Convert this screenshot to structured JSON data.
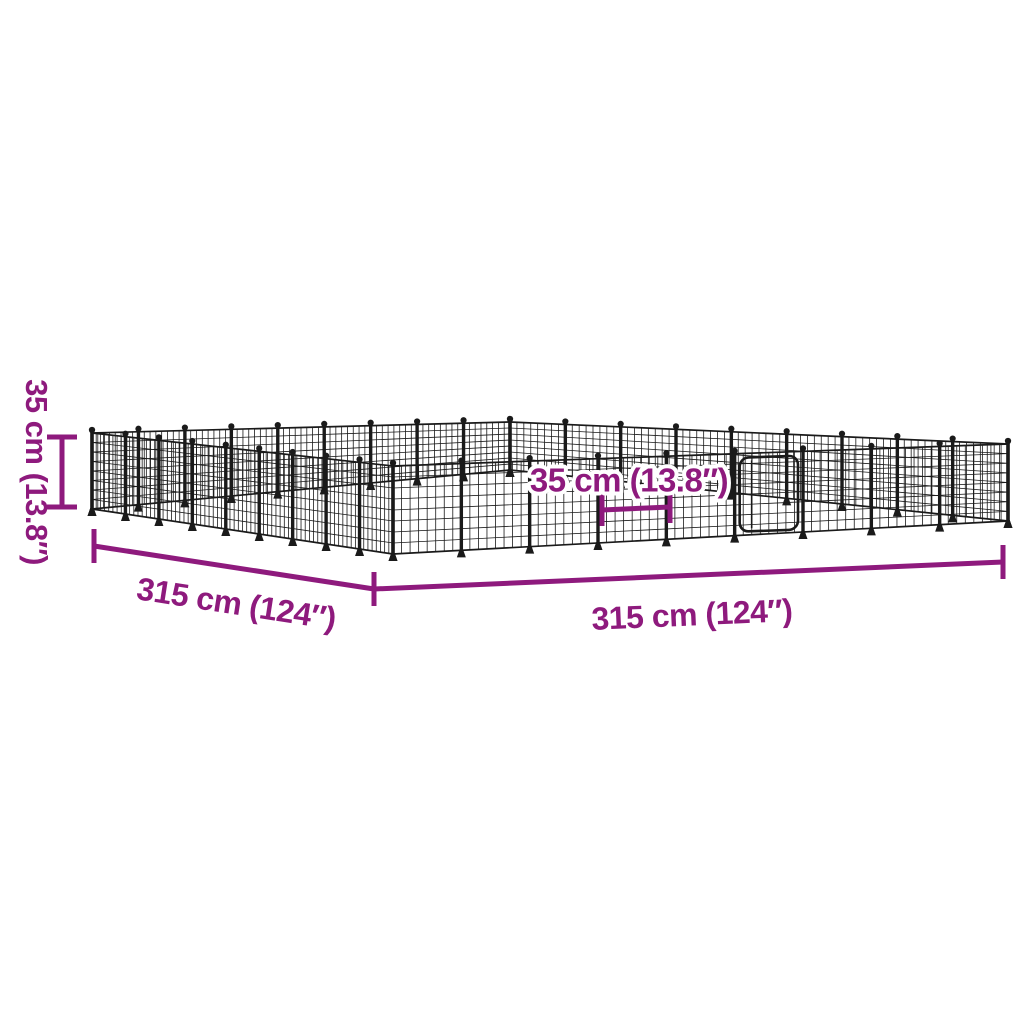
{
  "colors": {
    "background": "#ffffff",
    "dimension_accent": "#8E1A7D",
    "wire": "#1a1a1a"
  },
  "diagram": {
    "subject": "Wire mesh pet playpen with door, shown in perspective with dimension annotations",
    "labels": {
      "height": "35 cm (13.8″)",
      "side_left": "315 cm (124″)",
      "side_right": "315 cm (124″)",
      "panel_width": "35 cm (13.8″)"
    },
    "measurements": [
      {
        "name": "height",
        "cm": 35,
        "inches": 13.8
      },
      {
        "name": "side-left",
        "cm": 315,
        "inches": 124
      },
      {
        "name": "side-right",
        "cm": 315,
        "inches": 124
      },
      {
        "name": "panel-width",
        "cm": 35,
        "inches": 13.8
      }
    ]
  }
}
